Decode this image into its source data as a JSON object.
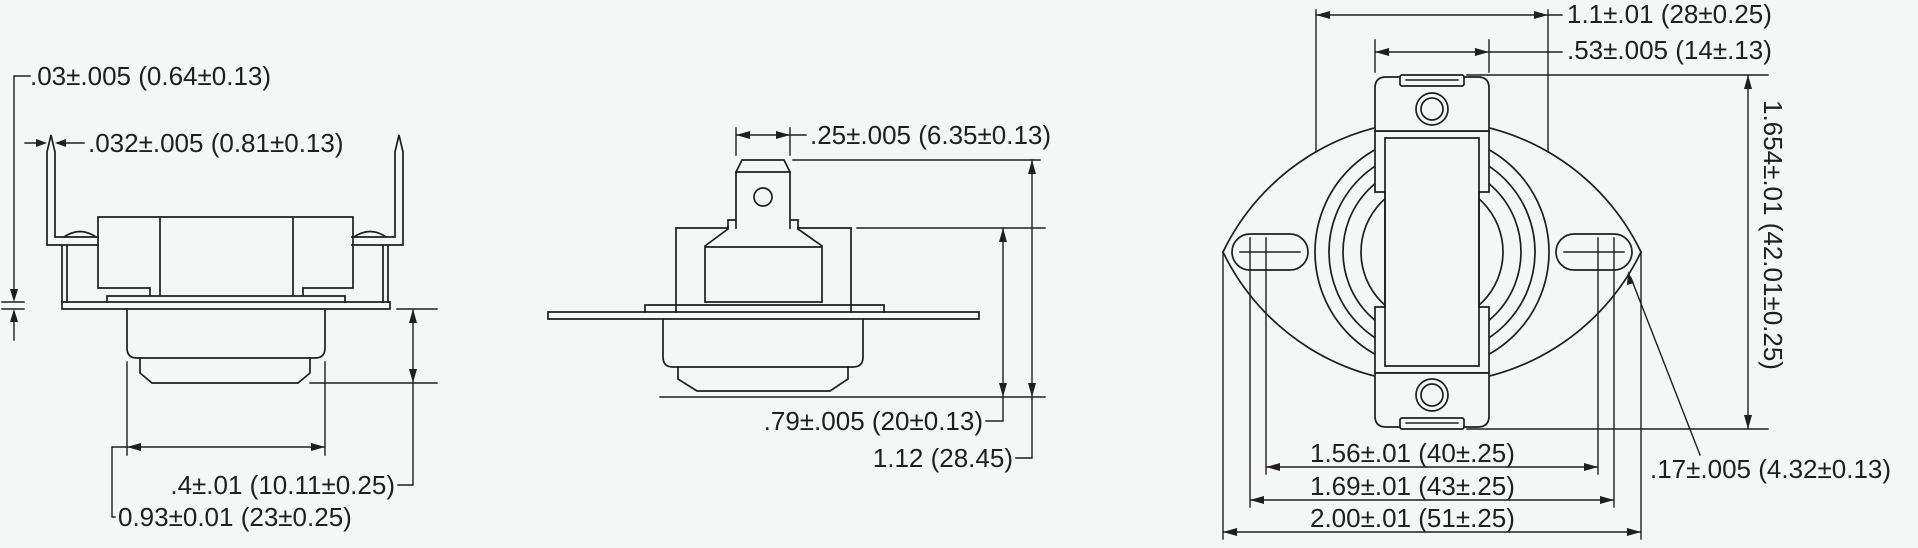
{
  "colors": {
    "background": "#f5f6f6",
    "line": "#1f1f1f"
  },
  "front_view": {
    "flange_thickness": ".03±.005 (0.64±0.13)",
    "terminal_pin_thickness": ".032±.005 (0.81±0.13)",
    "cap_depth": ".4±.01 (10.11±0.25)",
    "cap_diameter": "0.93±0.01 (23±0.25)"
  },
  "side_view": {
    "terminal_tab_width": ".25±.005 (6.35±0.13)",
    "case_height": ".79±.005 (20±0.13)",
    "overall_height": "1.12 (28.45)"
  },
  "top_view": {
    "case_diameter": "1.1±.01 (28±0.25)",
    "terminal_block_width": ".53±.005 (14±.13)",
    "overall_width": "1.654±.01 (42.01±0.25)",
    "slot_width": ".17±.005 (4.32±0.13)",
    "slot_inner_span": "1.56±.01 (40±.25)",
    "mounting_hole_spacing": "1.69±.01 (43±.25)",
    "flange_length": "2.00±.01 (51±.25)"
  }
}
